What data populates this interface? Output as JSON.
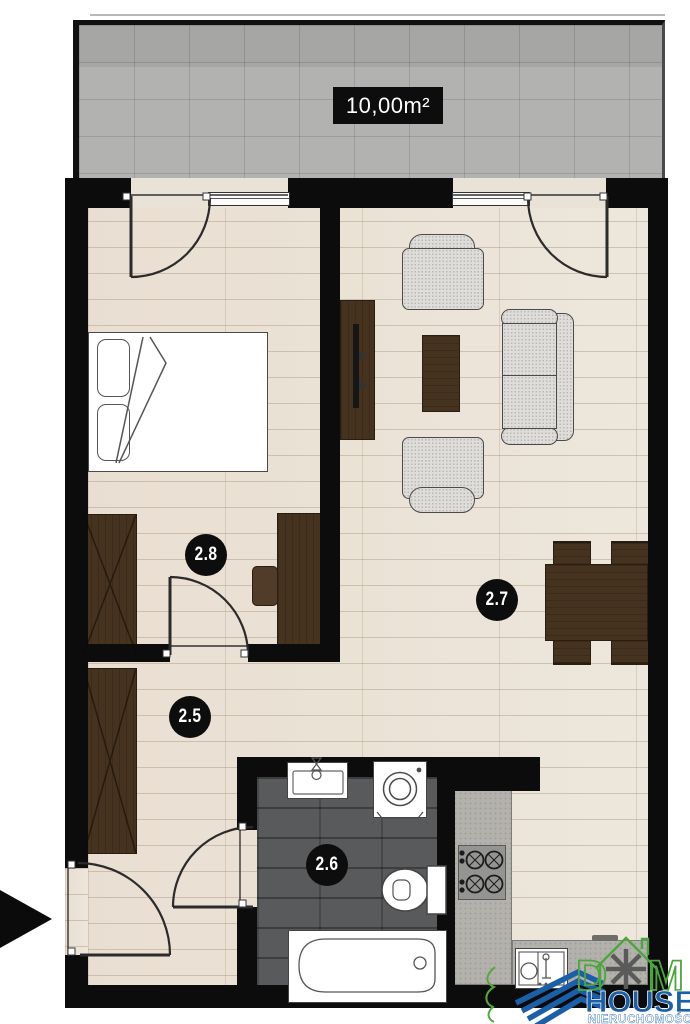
{
  "theme": {
    "wall": "#0c0c0c",
    "wood_floor": "#ece5da",
    "balcony_concrete": "#b2b3b1",
    "bath_tile": "#595a5c",
    "dark_wood": "#46331f",
    "upholstery": "#deddda",
    "counter": "#b3b1ac",
    "logo_green": "#4da63d",
    "logo_blue": "#1b5fa8",
    "label_bg": "#0d0d0d",
    "label_text": "#ffffff"
  },
  "balcony": {
    "area_label": "10,00m²"
  },
  "rooms": [
    {
      "name": "bedroom",
      "number": "2.8"
    },
    {
      "name": "living-room",
      "number": "2.7"
    },
    {
      "name": "hallway",
      "number": "2.5"
    },
    {
      "name": "bathroom",
      "number": "2.6"
    }
  ],
  "branding": {
    "dom_d": "D",
    "dom_m": "M",
    "house": "HOUSE",
    "subtitle": "NIERUCHOMOŚCI"
  }
}
